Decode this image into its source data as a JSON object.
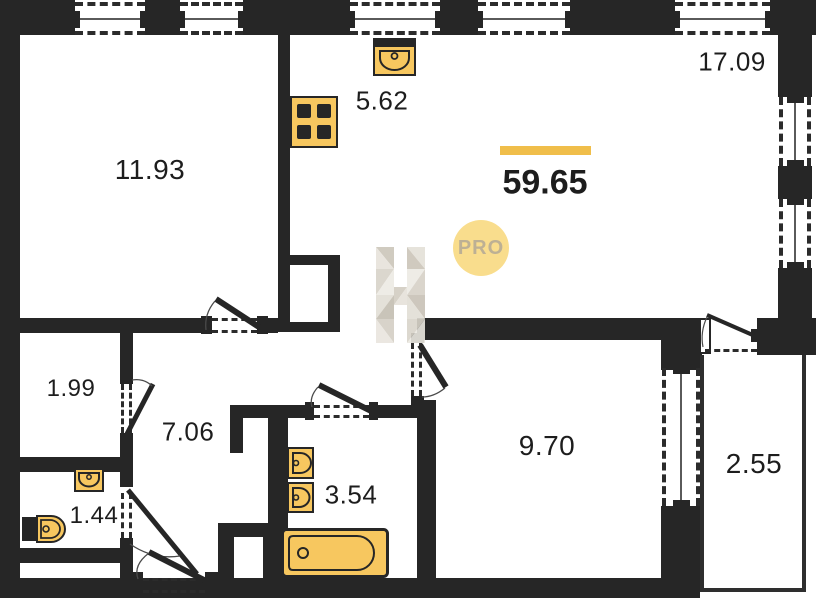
{
  "plan": {
    "total_area_label": "59.65",
    "badge": "PRO",
    "watermark": "H",
    "rooms": [
      {
        "name": "room",
        "area": "11.93"
      },
      {
        "name": "kitchen",
        "area": "5.62"
      },
      {
        "name": "living-area",
        "area": "17.09"
      },
      {
        "name": "storage",
        "area": "1.99"
      },
      {
        "name": "hallway",
        "area": "7.06"
      },
      {
        "name": "bathroom",
        "area": "3.54"
      },
      {
        "name": "wc",
        "area": "1.44"
      },
      {
        "name": "bedroom",
        "area": "9.70"
      },
      {
        "name": "balcony",
        "area": "2.55"
      }
    ],
    "icons": [
      "kitchen-sink-icon",
      "stove-icon",
      "bathroom-sink-icon",
      "toilet-icon",
      "bathtub-icon",
      "wc-sink-icon",
      "wc-toilet-icon"
    ],
    "colors": {
      "wall": "#262626",
      "fixture_fill": "#F7C75F",
      "fixture_stroke": "#262626",
      "accent_bar": "#F0BE4A",
      "pro_circle": "#F9DD8D",
      "pro_text": "#BDB094",
      "watermark_light": "#E7E3DB",
      "watermark_dark": "#C4BEB2",
      "text": "#1D1D1D"
    }
  }
}
